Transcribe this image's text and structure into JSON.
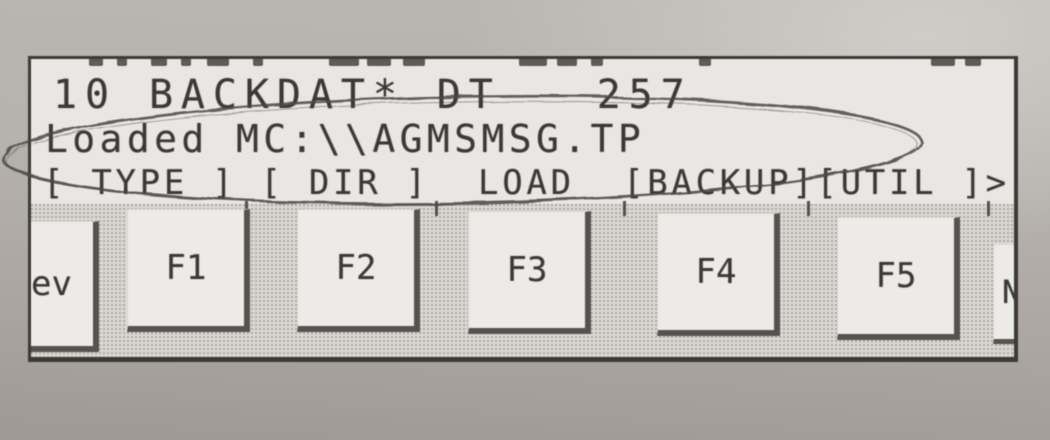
{
  "screen": {
    "status_line": "10 BACKDAT* DT   257",
    "message_line": "Loaded MC:\\\\AGMSMSG.TP",
    "softkey_line": "[ TYPE ] [ DIR ]  LOAD  [BACKUP][UTIL ]>"
  },
  "keys": {
    "prev_visible_label": "ev",
    "function_keys": [
      "F1",
      "F2",
      "F3",
      "F4",
      "F5"
    ],
    "next_visible_label": "N"
  },
  "annotation": {
    "type": "hand-drawn-ellipse",
    "circled_text": "Loaded MC:\\\\AGMSMSG.TP"
  },
  "colors": {
    "frame_border": "#3b3a37",
    "screen_bg": "#e9e7e3",
    "halftone_bg": "#dbd8d4",
    "ink": "#3b3935",
    "key_shadow": "#55534f",
    "annotation_stroke": "#4b4845"
  },
  "top_fragments": [
    {
      "x": 58,
      "w": 14
    },
    {
      "x": 86,
      "w": 10
    },
    {
      "x": 120,
      "w": 16
    },
    {
      "x": 150,
      "w": 10
    },
    {
      "x": 176,
      "w": 22
    },
    {
      "x": 222,
      "w": 10
    },
    {
      "x": 298,
      "w": 30
    },
    {
      "x": 336,
      "w": 24
    },
    {
      "x": 372,
      "w": 22
    },
    {
      "x": 488,
      "w": 28
    },
    {
      "x": 526,
      "w": 20
    },
    {
      "x": 560,
      "w": 12
    },
    {
      "x": 668,
      "w": 12
    },
    {
      "x": 900,
      "w": 24
    },
    {
      "x": 934,
      "w": 16
    }
  ],
  "separator_ticks": [
    214,
    404,
    592,
    776,
    956
  ]
}
